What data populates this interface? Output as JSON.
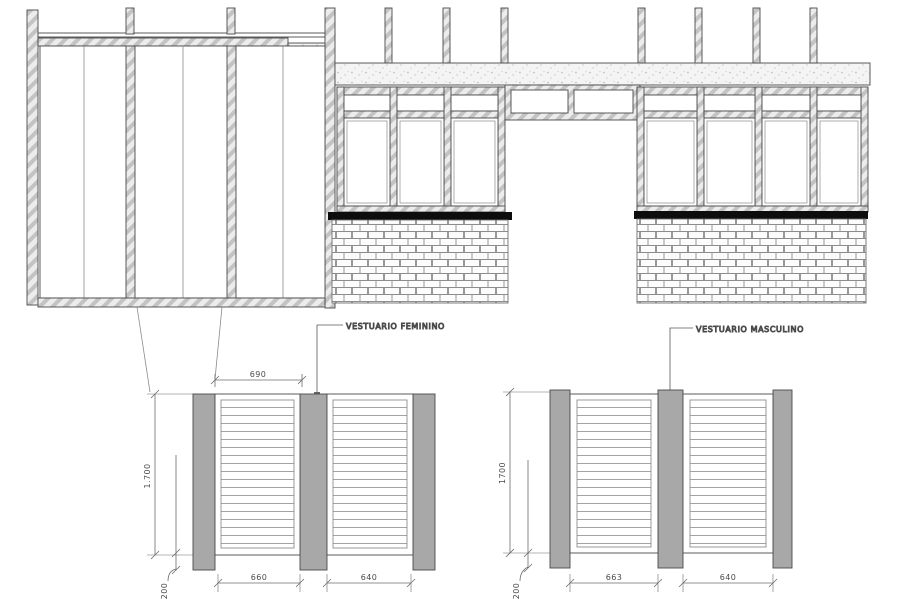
{
  "drawing": {
    "left_detail": {
      "label": "VESTUARIO FEMININO",
      "width_dim": "690",
      "height_dim": "1.700",
      "base_dim": "200",
      "door1_dim": "660",
      "door2_dim": "640"
    },
    "right_detail": {
      "label": "VESTUARIO MASCULINO",
      "height_dim": "1700",
      "base_dim": "200",
      "door1_dim": "663",
      "door2_dim": "640"
    },
    "colors": {
      "line": "#4a4a4a",
      "sill": "#0d0d0d",
      "post_gray": "#a8a8a8"
    }
  }
}
